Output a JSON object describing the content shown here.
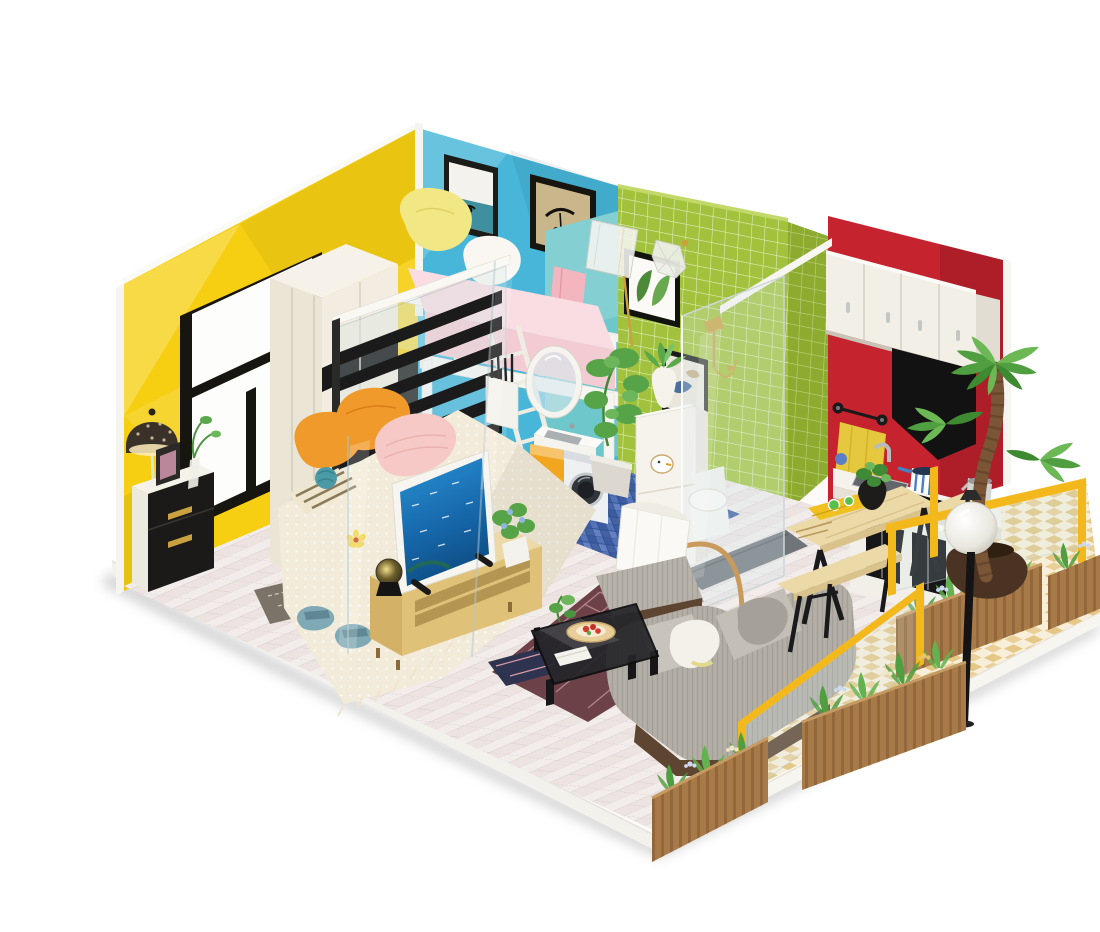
{
  "scene": {
    "subject": "DIY miniature dollhouse kit - one-room apartment diorama photographed on a white background",
    "style": "isometric product photo, no text, no UI",
    "background": "#ffffff"
  },
  "palette": {
    "yellow_wall": "#f6cf12",
    "blue_wall": "#47b6d8",
    "teal_wall": "#6ec7cb",
    "green_tile": "#a2c23e",
    "green_tile_side": "#8cab2f",
    "red_wall": "#c5232e",
    "floor_base": "#ede4e2",
    "bathroom_floor": "#4a69ae",
    "balcony_light": "#f8efda",
    "railing": "#f3b91c",
    "rug": "#6d4148",
    "sofa": "#b3afa6",
    "wood": "#ecd9a8",
    "wood_dark": "#5d4531",
    "mattress": "#f9dde2",
    "towel": "#e5c83d",
    "planter": "#a87a47",
    "palm": "#4f9e3f",
    "pillow_orange": "#f09a2c",
    "pillow_pink": "#f6c9c6",
    "slippers": "#7fa9b4",
    "washer_door": "#f2a51f"
  },
  "rooms": {
    "bedroom": {
      "label": "bedroom",
      "items": [
        "double bed with cream lace throw",
        "orange and pink pillows",
        "black and white nightstand with gold handles",
        "filigree floor lamp",
        "TV on light wooden media stand",
        "blue slippers",
        "dark doormat"
      ]
    },
    "loft": {
      "label": "loft bunk",
      "items": [
        "white loft bed with pink mattress",
        "yellow pillow",
        "white ladder",
        "white guard railing",
        "two framed art prints",
        "clear shade floor lamp"
      ]
    },
    "bathroom": {
      "label": "bathroom",
      "items": [
        "green mosaic tile walls",
        "glass shower with gold fixtures",
        "white toilet",
        "oval mirror and washbasin",
        "washing machine with yellow door",
        "white storage tower with duck stickers",
        "potted plants",
        "blue mosaic floor"
      ]
    },
    "kitchen": {
      "label": "kitchen",
      "items": [
        "red feature wall",
        "white upper cabinets",
        "black range hood",
        "yellow hand towel",
        "counter with sink, hob, striped pan and kettle",
        "white base cabinet with black panels"
      ]
    },
    "living": {
      "label": "living room",
      "items": [
        "grey fabric sofa with cushions",
        "grey ottoman",
        "black glass coffee table with snack plate",
        "maroon geometric rug",
        "white arc floor lamp",
        "wooden dining table with benches",
        "yellow laptop"
      ]
    },
    "balcony": {
      "label": "balcony",
      "items": [
        "yellow railing with glass",
        "diamond tiled floor",
        "wooden slat flower planters",
        "potted palm tree",
        "globe street lamp"
      ]
    }
  }
}
